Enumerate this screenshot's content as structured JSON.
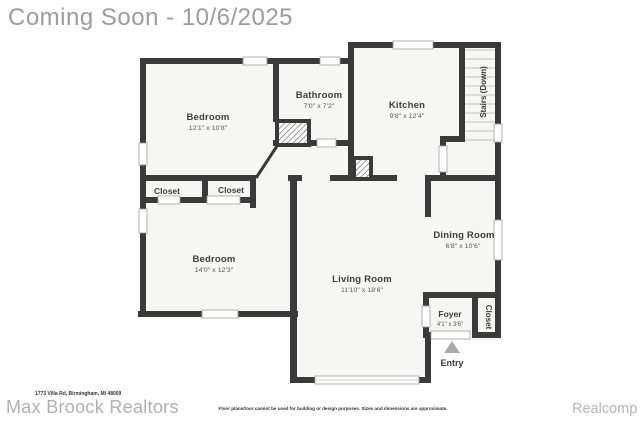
{
  "header": {
    "title": "Coming Soon - 10/6/2025"
  },
  "plan": {
    "rooms": [
      {
        "label": "Bedroom",
        "dims": "12'1\" x 10'8\""
      },
      {
        "label": "Bathroom",
        "dims": "7'0\" x 7'2\""
      },
      {
        "label": "Kitchen",
        "dims": "9'8\" x 12'4\""
      },
      {
        "label": "Stairs (Down)",
        "dims": ""
      },
      {
        "label": "Closet",
        "dims": ""
      },
      {
        "label": "Closet",
        "dims": ""
      },
      {
        "label": "Bedroom",
        "dims": "14'0\" x 12'3\""
      },
      {
        "label": "Living Room",
        "dims": "11'10\" x 18'6\""
      },
      {
        "label": "Dining Room",
        "dims": "6'8\" x 10'6\""
      },
      {
        "label": "Foyer",
        "dims": "4'1\" x 3'6\""
      },
      {
        "label": "Closet",
        "dims": ""
      },
      {
        "label": "Entry",
        "dims": ""
      }
    ]
  },
  "footer": {
    "address": "1773 Villa Rd, Birmingham, MI 48009",
    "brand": "Max Broock Realtors",
    "disclaimer": "Floor plans/tour cannot be used for building or design purposes. Sizes and dimensions are approximate.",
    "provider": "Realcomp"
  },
  "colors": {
    "wall": "#3a3a3a",
    "floor": "#f6f6f5",
    "watermark": "#b0b0b0",
    "label_text": "#3d3d3d"
  }
}
